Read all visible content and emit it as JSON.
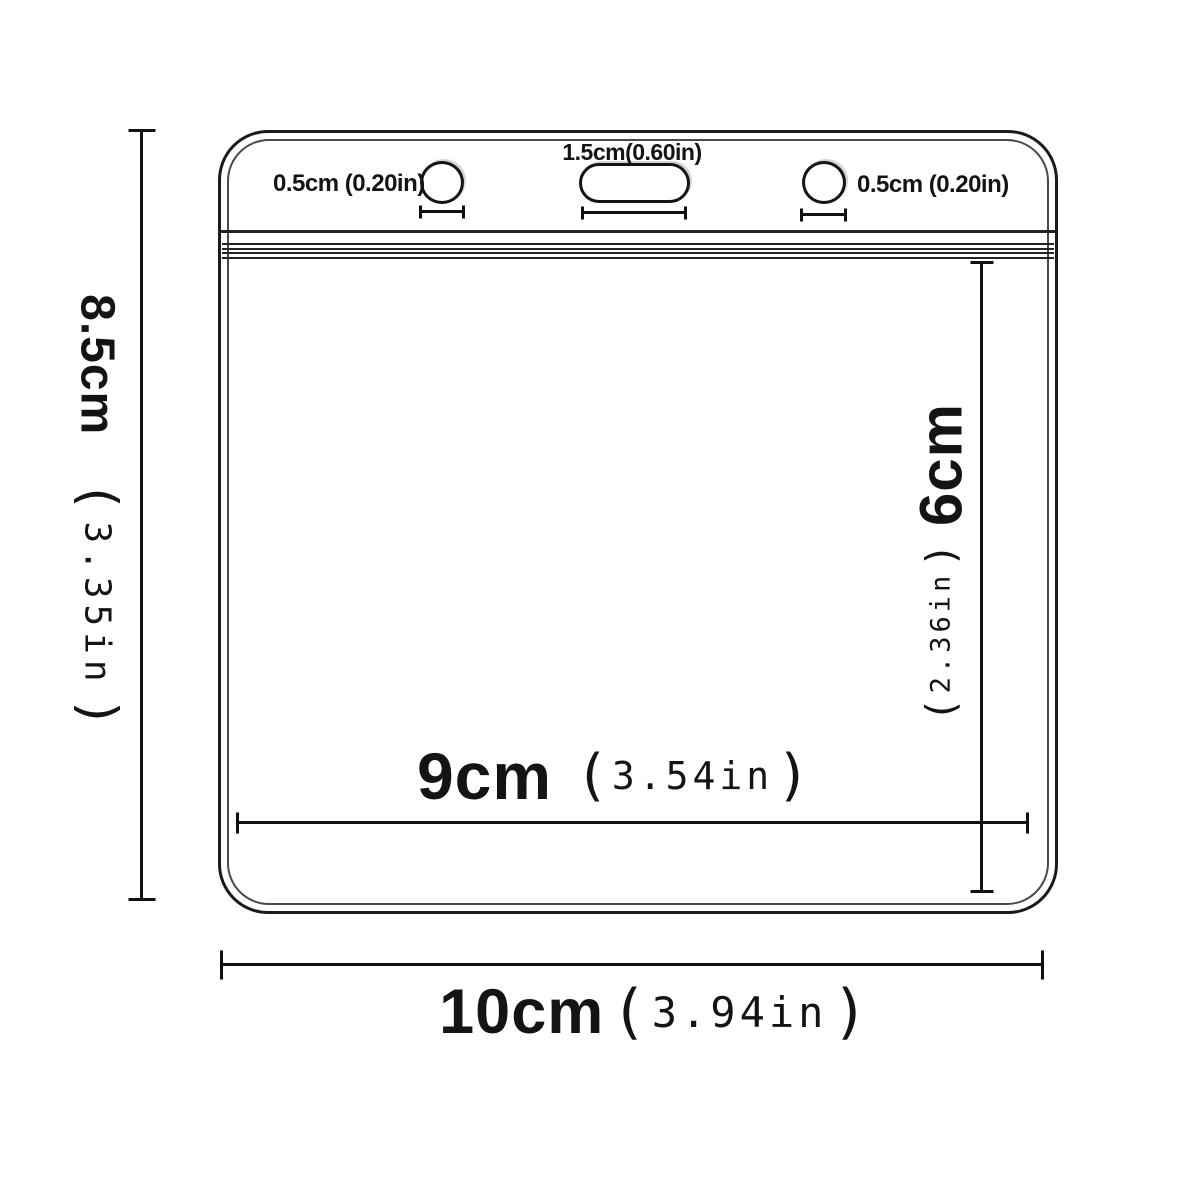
{
  "parens": {
    "open": "(",
    "close": ")"
  },
  "labels": {
    "hole_left": "0.5cm (0.20in)",
    "slot": "1.5cm(0.60in)",
    "hole_right": "0.5cm (0.20in)"
  },
  "dimensions": {
    "height": {
      "cm": "8.5cm",
      "inch": "3.35in"
    },
    "width": {
      "cm": "10cm",
      "inch": "3.94in"
    },
    "inner_width": {
      "cm": "9cm",
      "inch": "3.54in"
    },
    "inner_height": {
      "cm": "6cm",
      "inch": "2.36in"
    }
  },
  "colors": {
    "ink": "#1a1a1a",
    "background": "#ffffff"
  }
}
